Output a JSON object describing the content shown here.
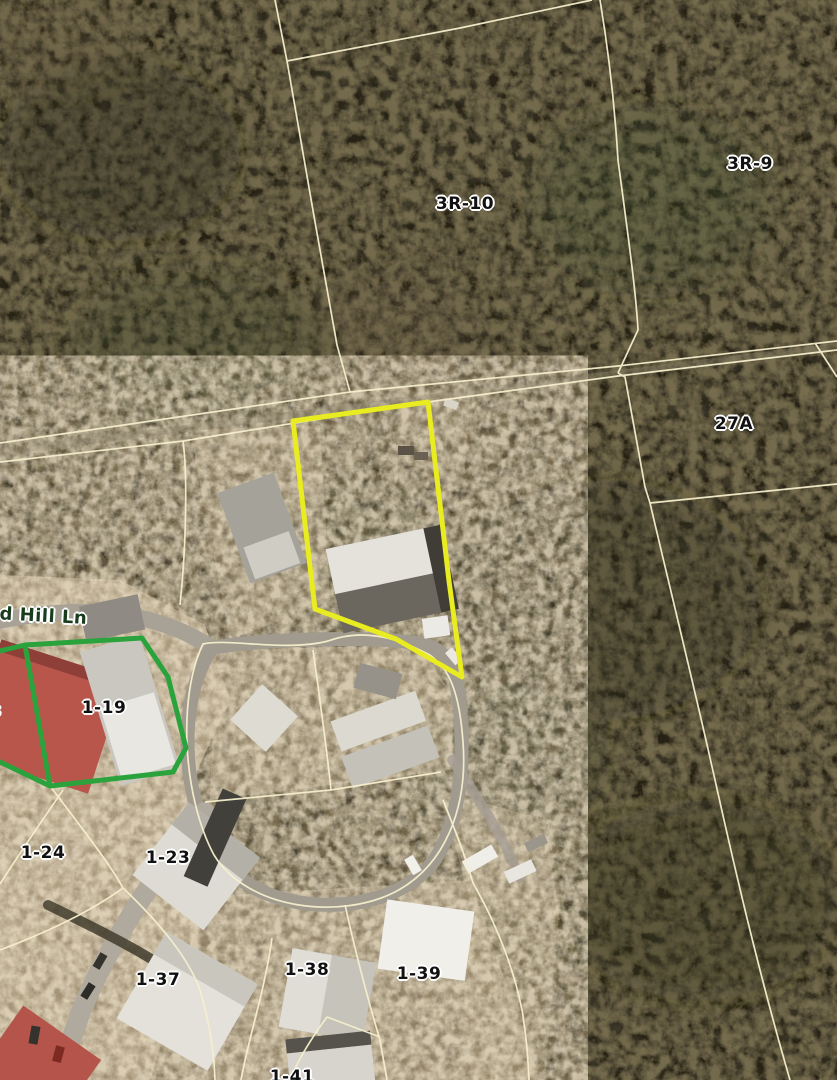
{
  "map": {
    "view": "aerial-parcel-map",
    "street_label": "ld Hill Ln",
    "labels": [
      {
        "text": "3R-10",
        "x": 465,
        "y": 204,
        "kind": "parcel"
      },
      {
        "text": "3R-9",
        "x": 750,
        "y": 164,
        "kind": "parcel"
      },
      {
        "text": "27A",
        "x": 734,
        "y": 424,
        "kind": "parcel"
      },
      {
        "text": "1-19",
        "x": 104,
        "y": 708,
        "kind": "parcel"
      },
      {
        "text": "8",
        "x": -5,
        "y": 712,
        "kind": "parcel"
      },
      {
        "text": "1-24",
        "x": 43,
        "y": 853,
        "kind": "parcel"
      },
      {
        "text": "1-23",
        "x": 168,
        "y": 858,
        "kind": "parcel"
      },
      {
        "text": "1-37",
        "x": 158,
        "y": 980,
        "kind": "parcel"
      },
      {
        "text": "1-38",
        "x": 307,
        "y": 970,
        "kind": "parcel"
      },
      {
        "text": "1-39",
        "x": 419,
        "y": 974,
        "kind": "parcel"
      },
      {
        "text": "1-41",
        "x": 292,
        "y": 1077,
        "kind": "parcel"
      },
      {
        "text": "ld Hill Ln",
        "x": 40,
        "y": 616,
        "kind": "street",
        "rot": 3
      }
    ],
    "colors": {
      "selected_outline": "#e8ec20",
      "secondary_outline": "#2aa33c",
      "parcel_line": "#f6efcd",
      "label_text": "#111111",
      "label_halo": "#ffffff",
      "street_label_text": "#183c1c",
      "road": "#a39c8f",
      "vegetation_dark": "#45402c",
      "ground_light": "#c6b598"
    }
  }
}
